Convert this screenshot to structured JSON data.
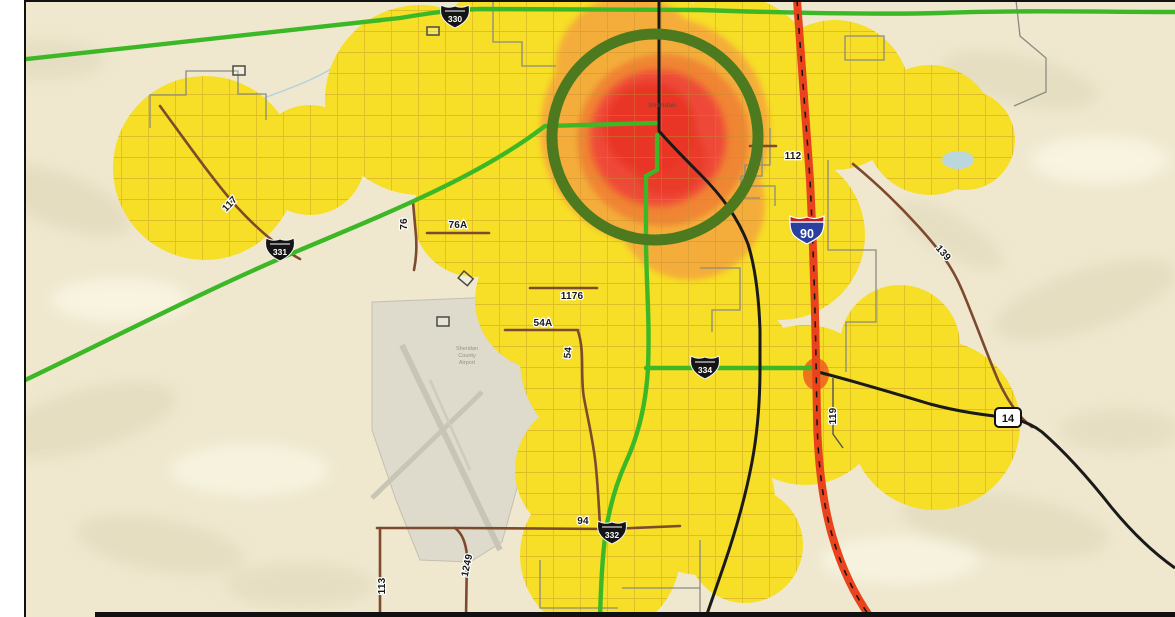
{
  "map": {
    "city_label": "Sheridan",
    "airport_label": {
      "line1": "Sheridan",
      "line2": "County",
      "line3": "Airport"
    },
    "shields": {
      "s330": "330",
      "s331": "331",
      "s332": "332",
      "s334": "334",
      "i90": "90",
      "us14": "14"
    },
    "road_labels": {
      "r117": "117",
      "r76": "76",
      "r76a": "76A",
      "r1176": "1176",
      "r54a": "54A",
      "r54": "54",
      "r112": "112",
      "r139": "139",
      "r119": "119",
      "r94": "94",
      "r113": "113",
      "r1249": "1249"
    },
    "heat_colors": {
      "low": "#f6df26",
      "medium": "#f4ac3b",
      "high": "#ee4a39",
      "core": "#e93628"
    },
    "annotation_circle_color": "#4d7a1e",
    "road_colors": {
      "interstate": "#e8431c",
      "major_black": "#1a1a1a",
      "state_green": "#3cb827",
      "county_brown": "#7d4a2e",
      "boundary_gray": "#8a8a82"
    }
  }
}
